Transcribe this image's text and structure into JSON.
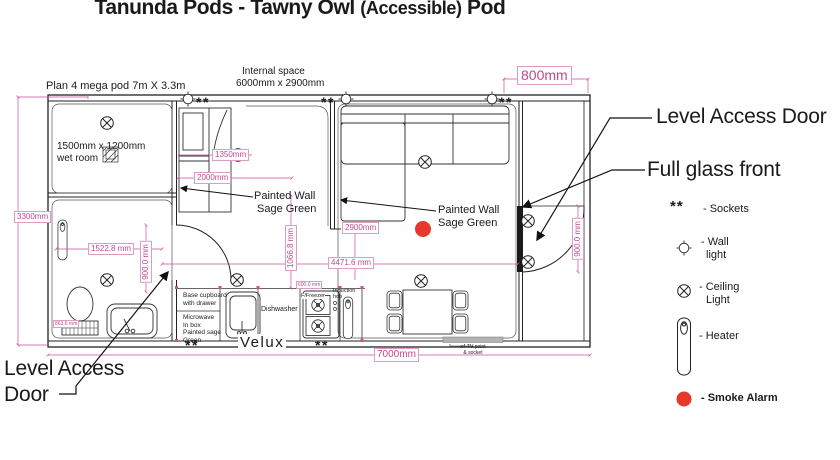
{
  "title": {
    "part1": "Tanunda Pods - Tawny Owl ",
    "part2": "(Accessible)",
    "part3": " Pod"
  },
  "plan": {
    "plan_label": "Plan 4 mega pod 7m X 3.3m",
    "internal_space_l1": "Internal space",
    "internal_space_l2": "6000mm x 2900mm",
    "wet_room_l1": "1500mm x 1200mm",
    "wet_room_l2": "wet room",
    "painted_wall_l1": "Painted Wall",
    "painted_wall_l2": "Sage Green",
    "velux": "Velux",
    "socket_symbol": "**",
    "tv_point_l1": "x4 TV point",
    "tv_point_l2": "& socket"
  },
  "kitchen": {
    "base_cupboard_l1": "Base cupboard",
    "base_cupboard_l2": "with drawer",
    "microwave_l1": "Microwave",
    "microwave_l2": "In box",
    "microwave_l3": "Painted sage",
    "microwave_l4": "Green",
    "dishwasher": "Dishwasher",
    "freezer": "F/Freezer",
    "induction_l1": "Induction",
    "induction_l2": "hob"
  },
  "dimensions": {
    "left_height": "3300mm",
    "bath_width": "1522.8 mm",
    "bath_door": "900.0 mm",
    "toilet_offset": "863.6 mm",
    "closet": "1350mm",
    "wardrobe_width": "2000mm",
    "hall": "1066.8 mm",
    "living_height": "2900mm",
    "living_width": "4471.6 mm",
    "counter": "600.0 mm",
    "total_width": "7000mm",
    "porch_width": "800mm",
    "entry_door": "900.0 mm"
  },
  "annotations": {
    "level_access_door_right": "Level Access Door",
    "full_glass_front": "Full glass front",
    "level_access_l1": "Level Access",
    "level_access_l2": "Door"
  },
  "legend": {
    "sockets_symbol": "**",
    "sockets": "- Sockets",
    "wall_light_l1": "- Wall",
    "wall_light_l2": "light",
    "ceiling_light_l1": "- Ceiling",
    "ceiling_light_l2": "Light",
    "heater": "- Heater",
    "smoke_alarm": "- Smoke Alarm"
  },
  "colors": {
    "dimension_pink": "#c9519c",
    "smoke_alarm_red": "#e8382d",
    "line_black": "#222222"
  }
}
